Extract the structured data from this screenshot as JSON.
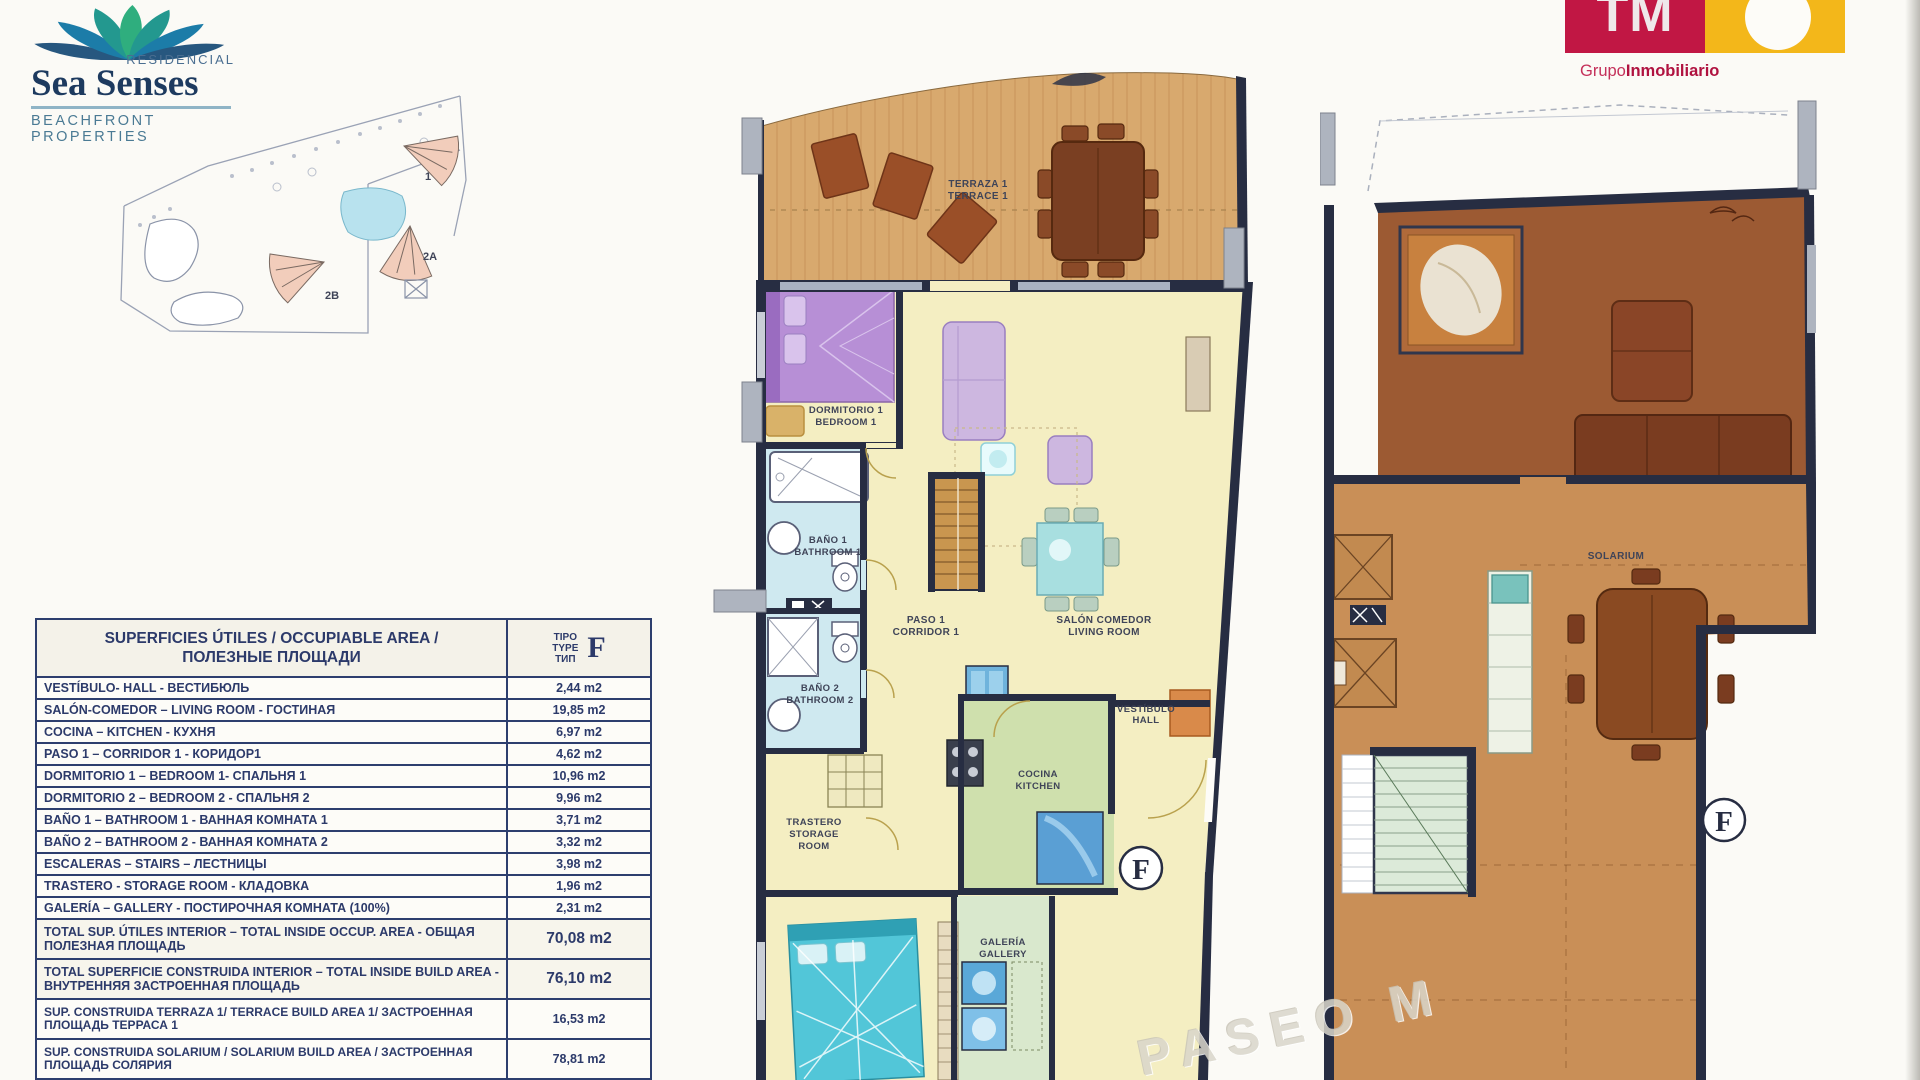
{
  "header": {
    "sea_senses": {
      "residencial": "RESIDENCIAL",
      "name": "Sea Senses",
      "tagline": "BEACHFRONT PROPERTIES"
    },
    "tm": {
      "monogram": "TM",
      "grupo": "Grupo",
      "inmobiliario": "Inmobiliario"
    }
  },
  "site_plan": {
    "building_labels": [
      "1",
      "2A",
      "2B"
    ]
  },
  "area_table": {
    "title_line1": "SUPERFICIES ÚTILES / OCCUPIABLE AREA /",
    "title_line2": "ПОЛЕЗНЫЕ ПЛОЩАДИ",
    "type_column": {
      "lines": [
        "TIPO",
        "TYPE",
        "ТИП"
      ],
      "type_letter": "F"
    },
    "rows": [
      {
        "label": "VESTÍBULO- HALL - ВЕСТИБЮЛЬ",
        "value": "2,44 m2"
      },
      {
        "label": "SALÓN-COMEDOR – LIVING ROOM - ГОСТИНАЯ",
        "value": "19,85 m2"
      },
      {
        "label": "COCINA – KITCHEN - КУХНЯ",
        "value": "6,97 m2"
      },
      {
        "label": "PASO 1 – CORRIDOR 1 - КОРИДОР1",
        "value": "4,62 m2"
      },
      {
        "label": "DORMITORIO 1 –  BEDROOM 1- СПАЛЬНЯ 1",
        "value": "10,96 m2"
      },
      {
        "label": "DORMITORIO 2 – BEDROOM 2 - СПАЛЬНЯ 2",
        "value": "9,96 m2"
      },
      {
        "label": "BAÑO 1 – BATHROOM 1 - ВАННАЯ КОМНАТА 1",
        "value": "3,71 m2"
      },
      {
        "label": "BAÑO 2 – BATHROOM 2 - ВАННАЯ КОМНАТА 2",
        "value": "3,32 m2"
      },
      {
        "label": "ESCALERAS – STAIRS – ЛЕСТНИЦЫ",
        "value": "3,98 m2"
      },
      {
        "label": "TRASTERO - STORAGE ROOM - КЛАДОВКА",
        "value": "1,96 m2"
      },
      {
        "label": "GALERÍA – GALLERY - ПОСТИРОЧНАЯ КОМНАТА (100%)",
        "value": "2,31 m2"
      },
      {
        "label": "TOTAL SUP. ÚTILES INTERIOR –  TOTAL INSIDE OCCUP. AREA - ОБЩАЯ ПОЛЕЗНАЯ ПЛОЩАДЬ",
        "value": "70,08 m2"
      },
      {
        "label": "TOTAL SUPERFICIE CONSTRUIDA INTERIOR –  TOTAL INSIDE BUILD AREA - ВНУТРЕННЯЯ ЗАСТРОЕННАЯ ПЛОЩАДЬ",
        "value": "76,10 m2"
      },
      {
        "label": "SUP. CONSTRUIDA TERRAZA 1/ TERRACE BUILD AREA 1/ ЗАСТРОЕННАЯ ПЛОЩАДЬ ТЕРРАСА 1",
        "value": "16,53 m2"
      },
      {
        "label": "SUP. CONSTRUIDA SOLARIUM / SOLARIUM BUILD AREA / ЗАСТРОЕННАЯ ПЛОЩАДЬ СОЛЯРИЯ",
        "value": "78,81 m2"
      },
      {
        "label": "TOTAL SUPERFICIE CONSTRUIDA PRIVADA – TOTAL",
        "value": ""
      }
    ]
  },
  "floor_plan_main": {
    "type_letter": "F",
    "rooms": {
      "terraza": [
        "TERRAZA 1",
        "TERRACE 1"
      ],
      "dormitorio1": [
        "DORMITORIO 1",
        "BEDROOM 1"
      ],
      "bano1": [
        "BAÑO 1",
        "BATHROOM 1"
      ],
      "bano2": [
        "BAÑO 2",
        "BATHROOM 2"
      ],
      "paso1": [
        "PASO 1",
        "CORRIDOR 1"
      ],
      "salon": [
        "SALÓN COMEDOR",
        "LIVING ROOM"
      ],
      "vestibulo": [
        "VESTÍBULO",
        "HALL"
      ],
      "cocina": [
        "COCINA",
        "KITCHEN"
      ],
      "trastero": [
        "TRASTERO",
        "STORAGE",
        "ROOM"
      ],
      "galeria": [
        "GALERÍA",
        "GALLERY"
      ]
    }
  },
  "floor_plan_solarium": {
    "room": "SOLARIUM",
    "type_letter": "F"
  },
  "watermark": "PASEO M",
  "colors": {
    "tm_red": "#c11744",
    "tm_yellow": "#f3b71a",
    "sea_senses_navy": "#1d3a5f",
    "wall_navy": "#272d42",
    "table_blue": "#2d3e6e",
    "wood_deck": "#d8a96e",
    "floor_yellow": "#f4eec2",
    "floor_green": "#cfe0ad",
    "floor_blue": "#cfe9f0",
    "solarium_tan": "#c98f57",
    "solarium_brown": "#9c5a33"
  }
}
